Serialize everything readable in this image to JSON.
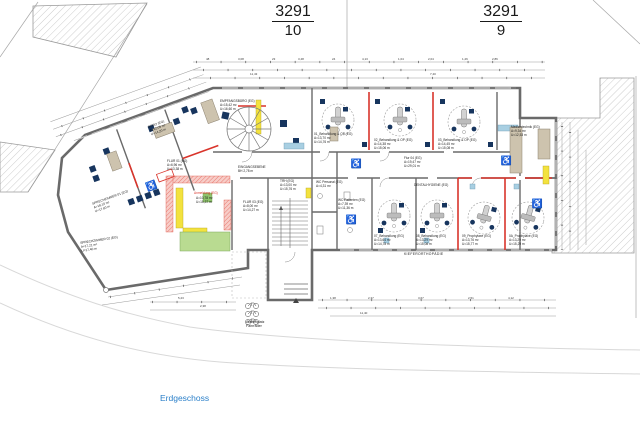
{
  "parcels": [
    {
      "numerator": "3291",
      "denominator": "10"
    },
    {
      "numerator": "3291",
      "denominator": "9"
    }
  ],
  "rooms": [
    {
      "id": "empfangsbuero",
      "label": "EMPFANGSBÜRO (EG)\nA=15,42 m²\nU=16,60 m"
    },
    {
      "id": "behandlung01",
      "label": "01_Behandlung & OP (EG)\nA=13,70 m²\nU=14,76 m"
    },
    {
      "id": "behandlung02",
      "label": "02_Behandlung & OP (EG)\nA=14,38 m²\nU=15,06 m"
    },
    {
      "id": "behandlung03",
      "label": "03_Behandlung & OP (EG)\nA=14,45 m²\nU=15,08 m"
    },
    {
      "id": "medizintechnik",
      "label": "Medizintechnik (EG)\nA=9,34 m²\nU=12,53 m"
    },
    {
      "id": "flur04",
      "label": "Flur 04 (EG)\nA=19,47 m²\nU=29,01 m"
    },
    {
      "id": "trh",
      "label": "TRH (EG)\nA=13,00 m²\nU=15,76 m"
    },
    {
      "id": "flur03",
      "label": "FLUR 03 (EG)\nA=8,00 m²\nU=14,27 m"
    },
    {
      "id": "wc-personal",
      "label": "WC Personal (EG)\nA=4,31 m²"
    },
    {
      "id": "wc-patienten",
      "label": "WC Patienten (EG)\nA=7,39 m²\nU=11,36 m"
    },
    {
      "id": "behandlung07",
      "label": "07_Behandlung (EG)\nA=13,64 m²\nU=14,78 m"
    },
    {
      "id": "behandlung08",
      "label": "08_Behandlung (EG)\nA=13,29 m²\nU=15,08 m"
    },
    {
      "id": "prophylaxe09",
      "label": "09_Prophylaxe (EG)\nA=13,76 m²\nU=15,77 m"
    },
    {
      "id": "prophylaxe0a",
      "label": "0A_Prophylaxe (EG)\nA=13,29 m²\nU=15,29 m"
    },
    {
      "id": "flur01",
      "label": "FLUR 01 (EG)\nA=6,96 m²\nU=13,38 m"
    },
    {
      "id": "anmeldung-area",
      "label": "A=10,78 m²\nU=15,37 m"
    },
    {
      "id": "sprechzimmer01",
      "label": "SPRECHZIMMER 01 (EG)\nA=18,10 m²\nU=17,60 m"
    },
    {
      "id": "sprechzimmer02",
      "label": "SPRECHZIMMER 02 (EG)\nA=17,21 m²\nU=17,40 m"
    },
    {
      "id": "buero-links",
      "label": "BÜRO (EG)\nA=12,05 m²\nU=14,20 m"
    },
    {
      "id": "eingangsebene",
      "label": "EINGANGSEBENE\nBH 2,78 m"
    },
    {
      "id": "dentalhygiene",
      "label": "DENTALHYGIENE (EG)"
    }
  ],
  "annotations": {
    "anmeldung_title": "Anmeldung (EG)",
    "kieferorthopaedie": "KIEFERORTHOPÄDIE",
    "abstellplatz": "Abstellplatz\nFahrräder",
    "erdgeschoss": "Erdgeschoss"
  },
  "dims": [
    "48",
    "3,08",
    "23",
    "3,48",
    "24",
    "4,13",
    "1,04",
    "2,04",
    "1,26",
    "2,86",
    "11,43",
    "7,40",
    "5,23",
    "2,38",
    "1,38",
    "2,37",
    "3,67",
    "2,51",
    "4,12",
    "11,40"
  ],
  "icons": {
    "wheelchair": "♿"
  },
  "colors": {
    "new_wall_red": "#d9342b",
    "wall_gray": "#6a6a6a",
    "furniture_navy": "#17355e",
    "counter_blue": "#a8cfe2",
    "cabinet_tan": "#cdc3ae",
    "highlight_yellow": "#f3e23e",
    "area_green": "#b9db91",
    "title_blue": "#2a7fc9",
    "hatch_gray": "#b8b8b8"
  }
}
